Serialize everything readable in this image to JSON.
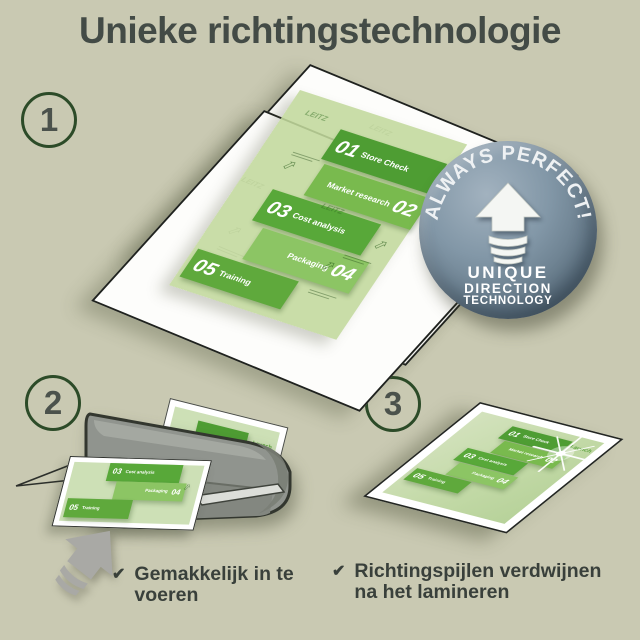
{
  "title": "Unieke richtingstechnologie",
  "steps": {
    "one": "1",
    "two": "2",
    "three": "3"
  },
  "badge": {
    "curved_text": "ALWAYS PERFECT!",
    "line1": "UNIQUE",
    "line2": "DIRECTION",
    "line3": "TECHNOLOGY"
  },
  "plan": {
    "launch_label": "Launch",
    "watermark": "LEITZ",
    "items": [
      {
        "num": "01",
        "label": "Store Check"
      },
      {
        "num": "02",
        "label": "Market research"
      },
      {
        "num": "03",
        "label": "Cost analysis"
      },
      {
        "num": "04",
        "label": "Packaging"
      },
      {
        "num": "05",
        "label": "Training"
      }
    ]
  },
  "checklist": [
    {
      "text": "Gemakkelijk in te voeren"
    },
    {
      "text": "Richtingspijlen verdwijnen na het lamineren"
    }
  ],
  "icons": {
    "check": "✔",
    "watermark_arrow": "⇧"
  },
  "colors": {
    "background": "#c9c9b2",
    "title_text": "#434b46",
    "step_circle_border": "#2c4b28",
    "pouch_green": "#cde0b6",
    "panel_green_dark": "#4e9d33",
    "panel_green_light": "#8cc564",
    "badge_blue_gray": "#8297a7",
    "laminator_gray": "#90948e",
    "check_text": "#39403b"
  }
}
